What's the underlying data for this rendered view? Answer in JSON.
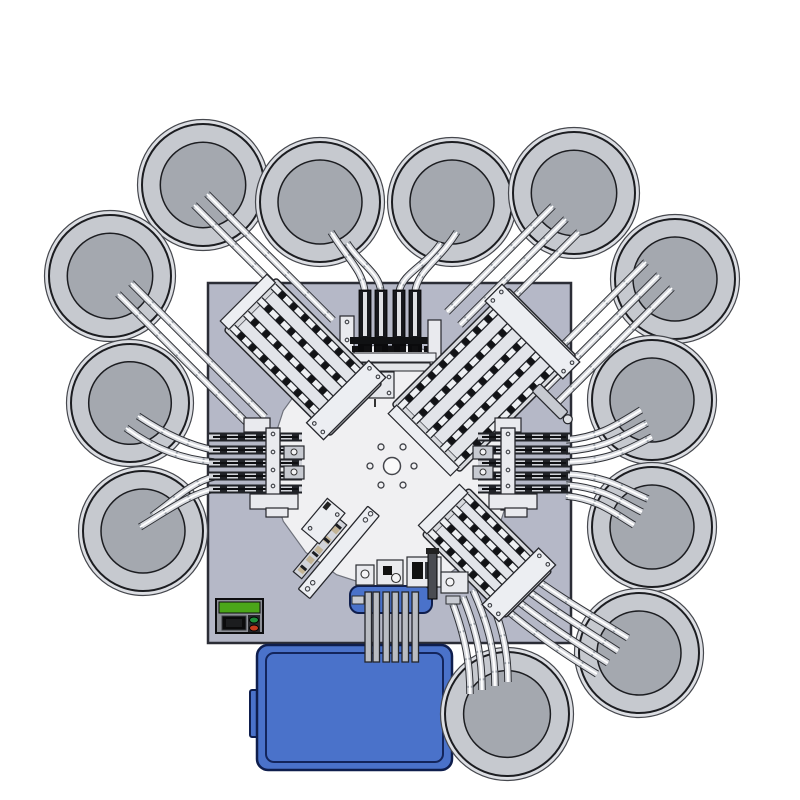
{
  "colors": {
    "bg": "#ffffff",
    "plate": "#b5b8c7",
    "plate_border": "#2b2d36",
    "table": "#f0f0f2",
    "table_border": "#6e717b",
    "bowl_halo": "#dcdee3",
    "bowl_halo_edge": "#46484e",
    "bowl_rim": "#c6c9cf",
    "bowl_inner": "#a4a8af",
    "bowl_outline": "#1c1d21",
    "rail_outline": "#2f3136",
    "rail_body": "#d9dbe0",
    "rail_joint": "#9aa0a8",
    "rail_highlight": "#ffffff",
    "dark_rail": "#17181c",
    "rail_stripe": "#dfe0e4",
    "station_slab": "#d8dade",
    "station_inner": "#e2e4e9",
    "station_plate": "#eceef2",
    "station_edge": "#26272c",
    "block_dark": "#121316",
    "block_tan": "#c3b496",
    "metal_light": "#e9eaee",
    "metal_mid": "#c7cad1",
    "metal_dark": "#4a4c52",
    "cabinet_blue": "#4a72ca",
    "cabinet_border": "#0f1e4d",
    "cabinet_inner": "#13255c",
    "panel_bezel": "#8d9097",
    "lcd_green": "#4ba619",
    "btn_green": "#1f8f3a",
    "btn_red": "#c33b1d",
    "gray_rail": "#b9bcc2"
  },
  "diagram": {
    "canvas": {
      "width": 800,
      "height": 800
    },
    "base_plate": {
      "x": 208,
      "y": 283,
      "width": 363,
      "height": 360
    },
    "rotary_table": {
      "cx": 392,
      "cy": 466,
      "radius": 122,
      "sides": 20
    },
    "hub": {
      "cx": 392,
      "cy": 466,
      "radius": 8.5,
      "bolt_circle_radius": 22,
      "bolt_radius": 3,
      "bolt_count": 6
    },
    "bowl_feeders": [
      {
        "cx": 203,
        "cy": 185,
        "r": 61
      },
      {
        "cx": 320,
        "cy": 202,
        "r": 60
      },
      {
        "cx": 452,
        "cy": 202,
        "r": 60
      },
      {
        "cx": 574,
        "cy": 193,
        "r": 61
      },
      {
        "cx": 110,
        "cy": 276,
        "r": 61
      },
      {
        "cx": 675,
        "cy": 279,
        "r": 60
      },
      {
        "cx": 130,
        "cy": 403,
        "r": 59
      },
      {
        "cx": 652,
        "cy": 400,
        "r": 60
      },
      {
        "cx": 143,
        "cy": 531,
        "r": 60
      },
      {
        "cx": 652,
        "cy": 527,
        "r": 60
      },
      {
        "cx": 639,
        "cy": 653,
        "r": 60
      },
      {
        "cx": 507,
        "cy": 714,
        "r": 62
      }
    ],
    "track_bundles": [
      {
        "name": "feed-tracks-top",
        "rails": [
          "M331,232 C350,262 362,270 365,292 L365,348",
          "M347,243 C362,266 379,272 381,292 L381,348",
          "M441,243 C426,266 403,272 399,292 L399,348",
          "M457,232 C438,262 418,270 415,292 L415,348"
        ]
      },
      {
        "name": "feed-tracks-upper-left",
        "rails": [
          "M207,194 L333,320",
          "M194,205 L320,331",
          "M131,283 L265,417",
          "M118,294 L252,428"
        ]
      },
      {
        "name": "feed-tracks-upper-right",
        "rails": [
          "M553,206 L447,312",
          "M566,219 L460,325",
          "M579,232 L473,338",
          "M646,262 L524,384",
          "M659,275 L537,397",
          "M672,288 L550,410"
        ]
      },
      {
        "name": "feed-tracks-left",
        "rails": [
          "M138,416 C168,436 192,446 214,450",
          "M126,428 C158,452 188,460 214,462",
          "M152,516 C174,500 192,482 214,477",
          "M140,527 C165,512 190,494 214,489"
        ]
      },
      {
        "name": "feed-tracks-right",
        "rails": [
          "M566,440 C600,437 618,424 641,410",
          "M566,451 C604,449 622,436 647,423",
          "M566,462 C610,461 628,449 652,437",
          "M566,474 C608,476 624,489 648,499",
          "M566,485 C604,488 620,501 642,512",
          "M566,496 C598,499 614,513 634,525"
        ]
      },
      {
        "name": "feed-tracks-lower-right",
        "rails": [
          "M520,568 C560,598 596,618 628,638",
          "M511,578 C552,610 586,630 618,651",
          "M501,588 C543,622 576,643 608,663",
          "M491,597 C534,634 566,655 597,674"
        ]
      },
      {
        "name": "feed-tracks-bottom-bowl",
        "rails": [
          "M483,582 C502,622 508,650 508,682",
          "M473,590 C490,628 495,655 495,686",
          "M463,597 C478,634 482,660 482,690",
          "M453,604 C466,640 470,664 470,694"
        ]
      }
    ],
    "cabinet": {
      "x": 257,
      "y": 645,
      "width": 195,
      "height": 125,
      "corner_radius": 11,
      "tab": {
        "x": 250,
        "y": 690,
        "width": 9,
        "height": 47
      }
    },
    "mount_bracket": {
      "x": 350,
      "y": 586,
      "width": 82,
      "height": 27,
      "corner_radius": 9
    },
    "cabinet_rails": {
      "xs": [
        365,
        373,
        383,
        392,
        402,
        412
      ],
      "y0": 592,
      "y1": 662,
      "width": 6.5
    },
    "control_panel": {
      "x": 216,
      "y": 599,
      "width": 47,
      "height": 34
    },
    "stations": [
      {
        "type": "vertical_feeder",
        "name": "station-top-press",
        "cx": 390
      },
      {
        "type": "diagonal_feeder",
        "name": "station-upper-left-feeder",
        "cx": 303,
        "cy": 357,
        "angle": 45,
        "len": 150,
        "wid": 74,
        "rails": 4
      },
      {
        "type": "diagonal_feeder",
        "name": "station-upper-right-feeder",
        "cx": 484,
        "cy": 380,
        "angle": -45,
        "len": 165,
        "wid": 96,
        "rails": 5,
        "cylinder": {
          "x": 26,
          "y": 42,
          "w": 11,
          "h": 40
        }
      },
      {
        "type": "horizontal_feeder",
        "name": "station-left-feeder",
        "side": "left"
      },
      {
        "type": "horizontal_feeder",
        "name": "station-right-feeder",
        "side": "right"
      },
      {
        "type": "small_plate",
        "name": "station-lower-left-plate",
        "cx": 330,
        "cy": 545,
        "angle": -50
      },
      {
        "type": "diagonal_feeder",
        "name": "station-lower-right-feeder",
        "cx": 487,
        "cy": 553,
        "angle": 45,
        "len": 118,
        "wid": 66,
        "rails": 4
      },
      {
        "type": "bottom_station",
        "name": "station-bottom-assembly"
      }
    ]
  }
}
